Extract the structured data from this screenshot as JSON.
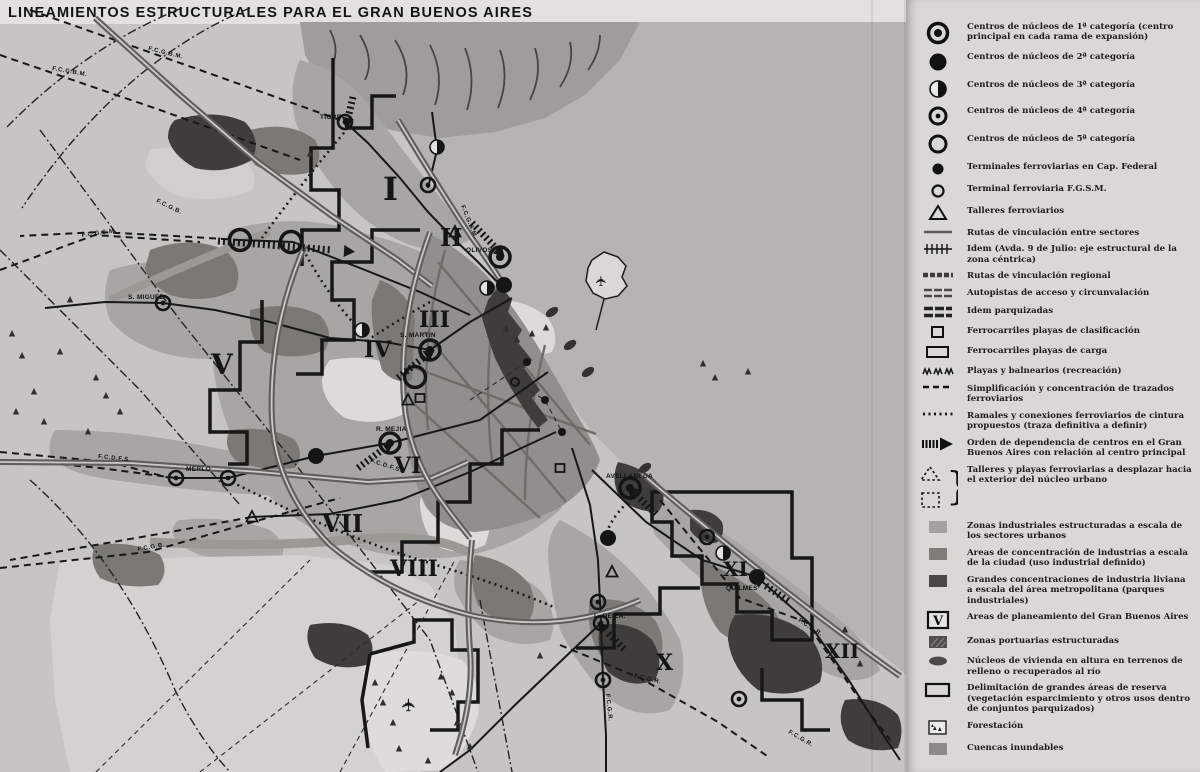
{
  "title": "LINEAMIENTOS ESTRUCTURALES PARA EL GRAN BUENOS AIRES",
  "colors": {
    "paper": "#d8d7d3",
    "river": "#b5b4b0",
    "urban": "#a7a6a2",
    "dense": "#918f8b",
    "industrial": "#7a7973",
    "dark": "#3e3d3a",
    "black": "#141413"
  },
  "legend": {
    "entries": [
      {
        "symbol": "center-cat1",
        "label": "Centros de núcleos de 1ª categoría (centro principal en cada rama de expansión)"
      },
      {
        "symbol": "center-cat2",
        "label": "Centros de núcleos de 2ª categoría"
      },
      {
        "symbol": "center-cat3",
        "label": "Centros de núcleos de 3ª categoría"
      },
      {
        "symbol": "center-cat4",
        "label": "Centros de núcleos de 4ª categoría"
      },
      {
        "symbol": "center-cat5",
        "label": "Centros de núcleos de 5ª categoría"
      },
      {
        "symbol": "terminal-capital",
        "label": "Terminales ferroviarias en Cap. Federal"
      },
      {
        "symbol": "terminal-fgsm",
        "label": "Terminal ferroviaria F.G.S.M."
      },
      {
        "symbol": "talleres",
        "label": "Talleres ferroviarios"
      },
      {
        "symbol": "ruta-sectores",
        "label": "Rutas de vinculación entre sectores"
      },
      {
        "symbol": "ruta-9julio",
        "label": "Idem (Avda. 9 de Julio: eje estructural de la zona céntrica)"
      },
      {
        "symbol": "ruta-regional",
        "label": "Rutas de vinculación regional"
      },
      {
        "symbol": "autopistas",
        "label": "Autopistas de acceso y circunvalación"
      },
      {
        "symbol": "autopistas-parquizadas",
        "label": "Idem parquizadas"
      },
      {
        "symbol": "playa-clasificacion",
        "label": "Ferrocarriles playas de clasificación"
      },
      {
        "symbol": "playa-carga",
        "label": "Ferrocarriles playas de carga"
      },
      {
        "symbol": "playas-balnearios",
        "label": "Playas y balnearios (recreación)"
      },
      {
        "symbol": "simplificacion",
        "label": "Simplificación y concentración de trazados ferroviarios"
      },
      {
        "symbol": "ramales-cintura",
        "label": "Ramales y conexiones ferroviarios de cintura propuestos (traza definitiva a definir)"
      },
      {
        "symbol": "orden-dependencia",
        "label": "Orden de dependencia de centros en el Gran Buenos Aires con relación al centro principal"
      },
      {
        "symbol": "talleres-desplazar",
        "label": "Talleres y playas ferroviarias a desplazar hacia el exterior del núcleo urbano"
      },
      {
        "symbol": "zonas-industriales",
        "label": "Zonas industriales estructuradas a escala de los sectores urbanos"
      },
      {
        "symbol": "areas-concentracion",
        "label": "Areas de concentración de industrias a escala de la ciudad (uso industrial definido)"
      },
      {
        "symbol": "grandes-concentraciones",
        "label": "Grandes concentraciones de industria liviana a escala del área metropolitana (parques industriales)"
      },
      {
        "symbol": "areas-planeamiento",
        "label": "Areas de planeamiento del Gran Buenos Aires"
      },
      {
        "symbol": "zonas-portuarias",
        "label": "Zonas portuarias estructuradas"
      },
      {
        "symbol": "nucleos-vivienda",
        "label": "Núcleos de vivienda en altura en terrenos de relleno o recuperados al río"
      },
      {
        "symbol": "delimitacion-reserva",
        "label": "Delimitación de grandes áreas de reserva (vegetación esparcimiento y otros usos dentro de conjuntos parquizados)"
      },
      {
        "symbol": "forestacion",
        "label": "Forestación"
      },
      {
        "symbol": "cuencas-inundables",
        "label": "Cuencas inundables"
      }
    ]
  },
  "map": {
    "place_labels": [
      {
        "text": "TIGRE",
        "x": 320,
        "y": 119
      },
      {
        "text": "OLIVOS",
        "x": 466,
        "y": 252
      },
      {
        "text": "S. MARTIN",
        "x": 400,
        "y": 337
      },
      {
        "text": "S. MIGUEL",
        "x": 128,
        "y": 299
      },
      {
        "text": "MERLO",
        "x": 186,
        "y": 471
      },
      {
        "text": "R. MEJIA",
        "x": 376,
        "y": 431
      },
      {
        "text": "AVELLANEDA",
        "x": 606,
        "y": 478
      },
      {
        "text": "QUILMES",
        "x": 726,
        "y": 590
      },
      {
        "text": "L. DE ZA.",
        "x": 594,
        "y": 618
      }
    ],
    "railway_labels": [
      {
        "text": "F.C.G.B.M.",
        "x": 148,
        "y": 50,
        "rot": 14
      },
      {
        "text": "F.C.G.B.M.",
        "x": 52,
        "y": 70,
        "rot": 10
      },
      {
        "text": "F.C.G.B.M.",
        "x": 461,
        "y": 206,
        "rot": 68
      },
      {
        "text": "F.C.G.S.M.",
        "x": 82,
        "y": 237,
        "rot": -8
      },
      {
        "text": "F.C.G.B.",
        "x": 156,
        "y": 202,
        "rot": 26
      },
      {
        "text": "F.C.D.F.S.",
        "x": 98,
        "y": 458,
        "rot": 6
      },
      {
        "text": "F.C.D.F.S.",
        "x": 370,
        "y": 462,
        "rot": 18
      },
      {
        "text": "F.C.G.B.",
        "x": 138,
        "y": 551,
        "rot": -10
      },
      {
        "text": "F.C.G.R.",
        "x": 798,
        "y": 621,
        "rot": 33
      },
      {
        "text": "F.C.G.R.",
        "x": 634,
        "y": 677,
        "rot": 14
      },
      {
        "text": "F.C.G.R.",
        "x": 606,
        "y": 694,
        "rot": 84
      },
      {
        "text": "F.C.G.R.",
        "x": 788,
        "y": 733,
        "rot": 30
      }
    ],
    "area_numerals": [
      {
        "text": "I",
        "x": 383,
        "y": 200,
        "size": 32
      },
      {
        "text": "II",
        "x": 440,
        "y": 246,
        "size": 24
      },
      {
        "text": "III",
        "x": 419,
        "y": 327,
        "size": 22
      },
      {
        "text": "IV",
        "x": 364,
        "y": 357,
        "size": 22
      },
      {
        "text": "V",
        "x": 211,
        "y": 374,
        "size": 28
      },
      {
        "text": "VI",
        "x": 394,
        "y": 473,
        "size": 22
      },
      {
        "text": "VII",
        "x": 322,
        "y": 532,
        "size": 24
      },
      {
        "text": "VIII",
        "x": 390,
        "y": 576,
        "size": 22
      },
      {
        "text": "X",
        "x": 656,
        "y": 670,
        "size": 22
      },
      {
        "text": "XI",
        "x": 723,
        "y": 576,
        "size": 20
      },
      {
        "text": "XII",
        "x": 825,
        "y": 658,
        "size": 20
      }
    ],
    "markers": [
      {
        "t": "cat1",
        "x": 500,
        "y": 257
      },
      {
        "t": "cat1",
        "x": 430,
        "y": 350
      },
      {
        "t": "cat1",
        "x": 390,
        "y": 443
      },
      {
        "t": "cat1",
        "x": 630,
        "y": 488
      },
      {
        "t": "cat2",
        "x": 316,
        "y": 456
      },
      {
        "t": "cat2",
        "x": 757,
        "y": 577
      },
      {
        "t": "cat2",
        "x": 608,
        "y": 538
      },
      {
        "t": "cat2",
        "x": 504,
        "y": 285
      },
      {
        "t": "cat3",
        "x": 437,
        "y": 147
      },
      {
        "t": "cat3",
        "x": 487,
        "y": 288
      },
      {
        "t": "cat3",
        "x": 723,
        "y": 553
      },
      {
        "t": "cat3",
        "x": 362,
        "y": 330
      },
      {
        "t": "cat4",
        "x": 345,
        "y": 122
      },
      {
        "t": "cat4",
        "x": 428,
        "y": 185
      },
      {
        "t": "cat4",
        "x": 163,
        "y": 303
      },
      {
        "t": "cat4",
        "x": 176,
        "y": 478
      },
      {
        "t": "cat4",
        "x": 228,
        "y": 478
      },
      {
        "t": "cat4",
        "x": 598,
        "y": 602
      },
      {
        "t": "cat4",
        "x": 601,
        "y": 623
      },
      {
        "t": "cat4",
        "x": 603,
        "y": 680
      },
      {
        "t": "cat4",
        "x": 707,
        "y": 537
      },
      {
        "t": "cat4",
        "x": 739,
        "y": 699
      },
      {
        "t": "cat5",
        "x": 240,
        "y": 240
      },
      {
        "t": "cat5",
        "x": 291,
        "y": 242
      },
      {
        "t": "cat5",
        "x": 415,
        "y": 377
      },
      {
        "t": "term",
        "x": 527,
        "y": 362
      },
      {
        "t": "term",
        "x": 545,
        "y": 400
      },
      {
        "t": "term",
        "x": 562,
        "y": 432
      },
      {
        "t": "termring",
        "x": 515,
        "y": 382
      },
      {
        "t": "tri",
        "x": 252,
        "y": 517
      },
      {
        "t": "tri",
        "x": 612,
        "y": 572
      },
      {
        "t": "tri",
        "x": 408,
        "y": 400
      },
      {
        "t": "tri",
        "x": 455,
        "y": 232
      },
      {
        "t": "sq",
        "x": 420,
        "y": 398
      },
      {
        "t": "sq",
        "x": 560,
        "y": 468
      },
      {
        "t": "viv",
        "x": 552,
        "y": 312
      },
      {
        "t": "viv",
        "x": 570,
        "y": 345
      },
      {
        "t": "viv",
        "x": 588,
        "y": 372
      },
      {
        "t": "viv",
        "x": 645,
        "y": 468
      },
      {
        "t": "plane",
        "x": 606,
        "y": 281
      },
      {
        "t": "plane",
        "x": 415,
        "y": 705
      }
    ]
  }
}
